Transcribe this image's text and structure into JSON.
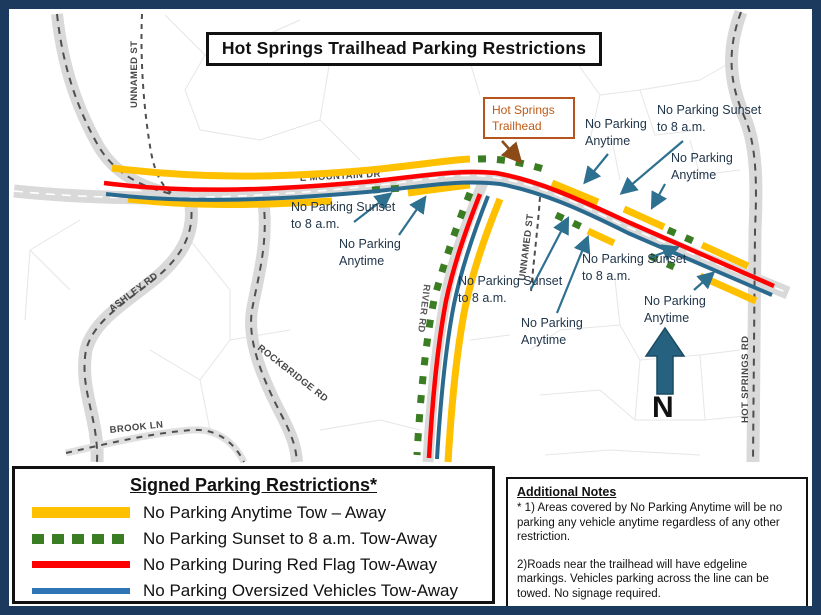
{
  "title": "Hot Springs Trailhead Parking Restrictions",
  "map": {
    "trailhead_label": "Hot Springs Trailhead",
    "north_label": "N",
    "streets": [
      {
        "name": "E MOUNTAIN DR"
      },
      {
        "name": "UNNAMED ST"
      },
      {
        "name": "UNNAMED ST"
      },
      {
        "name": "ASHLEY RD"
      },
      {
        "name": "ROCKBRIDGE RD"
      },
      {
        "name": "BROOK LN"
      },
      {
        "name": "HOT SPRINGS RD"
      },
      {
        "name": "RIVER RD"
      }
    ],
    "annotations": [
      {
        "text": "No Parking Anytime"
      },
      {
        "text": "No Parking Sunset to 8 a.m."
      },
      {
        "text": "No Parking Anytime"
      },
      {
        "text": "No Parking Sunset to 8 a.m."
      },
      {
        "text": "No Parking Anytime"
      },
      {
        "text": "No Parking Sunset to 8 a.m."
      },
      {
        "text": "No Parking Sunset to 8 a.m."
      },
      {
        "text": "No Parking Anytime"
      },
      {
        "text": "No Parking Anytime"
      }
    ]
  },
  "legend": {
    "title": "Signed Parking Restrictions*",
    "items": [
      {
        "label": "No Parking Anytime Tow – Away",
        "color": "#FFC000",
        "style": "solid"
      },
      {
        "label": "No Parking Sunset to 8 a.m. Tow-Away",
        "color": "#3B7D23",
        "style": "dashed"
      },
      {
        "label": "No Parking During Red Flag Tow-Away",
        "color": "#FF0000",
        "style": "solid"
      },
      {
        "label": "No Parking Oversized Vehicles Tow-Away",
        "color": "#2E75B6",
        "style": "solid"
      }
    ]
  },
  "notes": {
    "title": "Additional Notes",
    "note1": "* 1) Areas covered by No Parking Anytime will be no parking any vehicle anytime regardless of any other restriction.",
    "note2": "2)Roads near the trailhead will have edgeline markings. Vehicles parking across the line can be towed. No signage required."
  },
  "colors": {
    "page_border": "#1c3a5e",
    "no_parking_anytime": "#FFC000",
    "no_parking_sunset": "#3B7D23",
    "no_parking_red_flag": "#FF0000",
    "no_parking_oversized": "#2E75B6",
    "annotation_arrow": "#2e708f",
    "trailhead_callout": "#b5541c",
    "road_fill": "#d9d9d9"
  }
}
